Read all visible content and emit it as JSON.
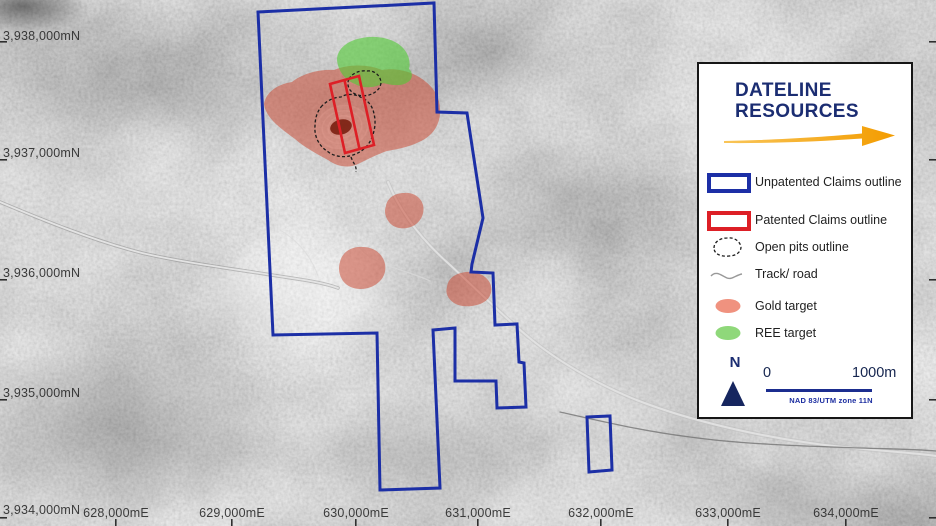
{
  "map": {
    "northing_labels": [
      "3,938,000mN",
      "3,937,000mN",
      "3,936,000mN",
      "3,935,000mN",
      "3,934,000mN"
    ],
    "easting_labels": [
      "628,000mE",
      "629,000mE",
      "630,000mE",
      "631,000mE",
      "632,000mE",
      "633,000mE",
      "634,000mE"
    ]
  },
  "legend": {
    "logo": {
      "line1": "DATELINE",
      "line2": "RESOURCES"
    },
    "items": [
      {
        "key": "unpatented-claims",
        "label": "Unpatented Claims outline",
        "color": "#1c2fa6"
      },
      {
        "key": "patented-claims",
        "label": "Patented Claims outline",
        "color": "#dd1f26"
      },
      {
        "key": "open-pits",
        "label": "Open pits outline",
        "color": "#1c1c1c"
      },
      {
        "key": "track-road",
        "label": "Track/ road",
        "color": "#999999"
      },
      {
        "key": "gold-target",
        "label": "Gold target",
        "color": "#f0927f"
      },
      {
        "key": "ree-target",
        "label": "REE target",
        "color": "#8fd87a"
      }
    ],
    "north_label": "N",
    "scale": {
      "start": "0",
      "end": "1000m",
      "datum": "NAD 83/UTM zone 11N"
    }
  },
  "colors": {
    "logo_navy": "#1b2d72",
    "arrow_orange": "#f5a21b",
    "unpatented_blue": "#1c2fa6",
    "patented_red": "#dd1f26",
    "gold_overlay": "#cc4630",
    "ree_overlay": "#50cc33",
    "pit_floor_maroon": "#7a1e10"
  }
}
